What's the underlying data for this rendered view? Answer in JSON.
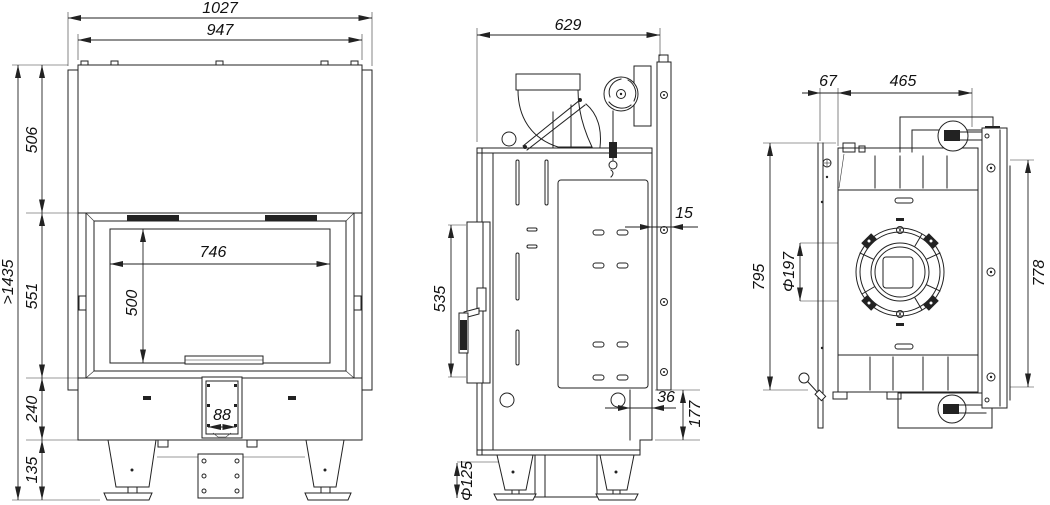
{
  "drawing": {
    "type": "technical-drawing",
    "subject": "fireplace-insert-three-view-dimensional-drawing",
    "background": "#ffffff",
    "line_color": "#222222",
    "views": [
      {
        "id": "front",
        "label": "front-view"
      },
      {
        "id": "side",
        "label": "side-view"
      },
      {
        "id": "rear",
        "label": "rear-view"
      }
    ],
    "dims": {
      "front_overall_width": "1027",
      "front_body_width": "947",
      "front_overall_height": ">1435",
      "front_hood_height": "506",
      "front_firebox_height": "551",
      "front_base_height": "240",
      "front_leg_height": "135",
      "front_glass_width": "746",
      "front_glass_height": "500",
      "front_ash_door_width": "88",
      "side_depth": "629",
      "side_door_height": "535",
      "side_frame_gap": "15",
      "side_rear_offset": "36",
      "side_rear_step_height": "177",
      "side_air_inlet_diameter": "Φ125",
      "rear_flange_offset": "67",
      "rear_body_width": "465",
      "rear_frame_height": "795",
      "rear_flue_diameter": "Φ197",
      "rear_panel_height": "778"
    }
  }
}
